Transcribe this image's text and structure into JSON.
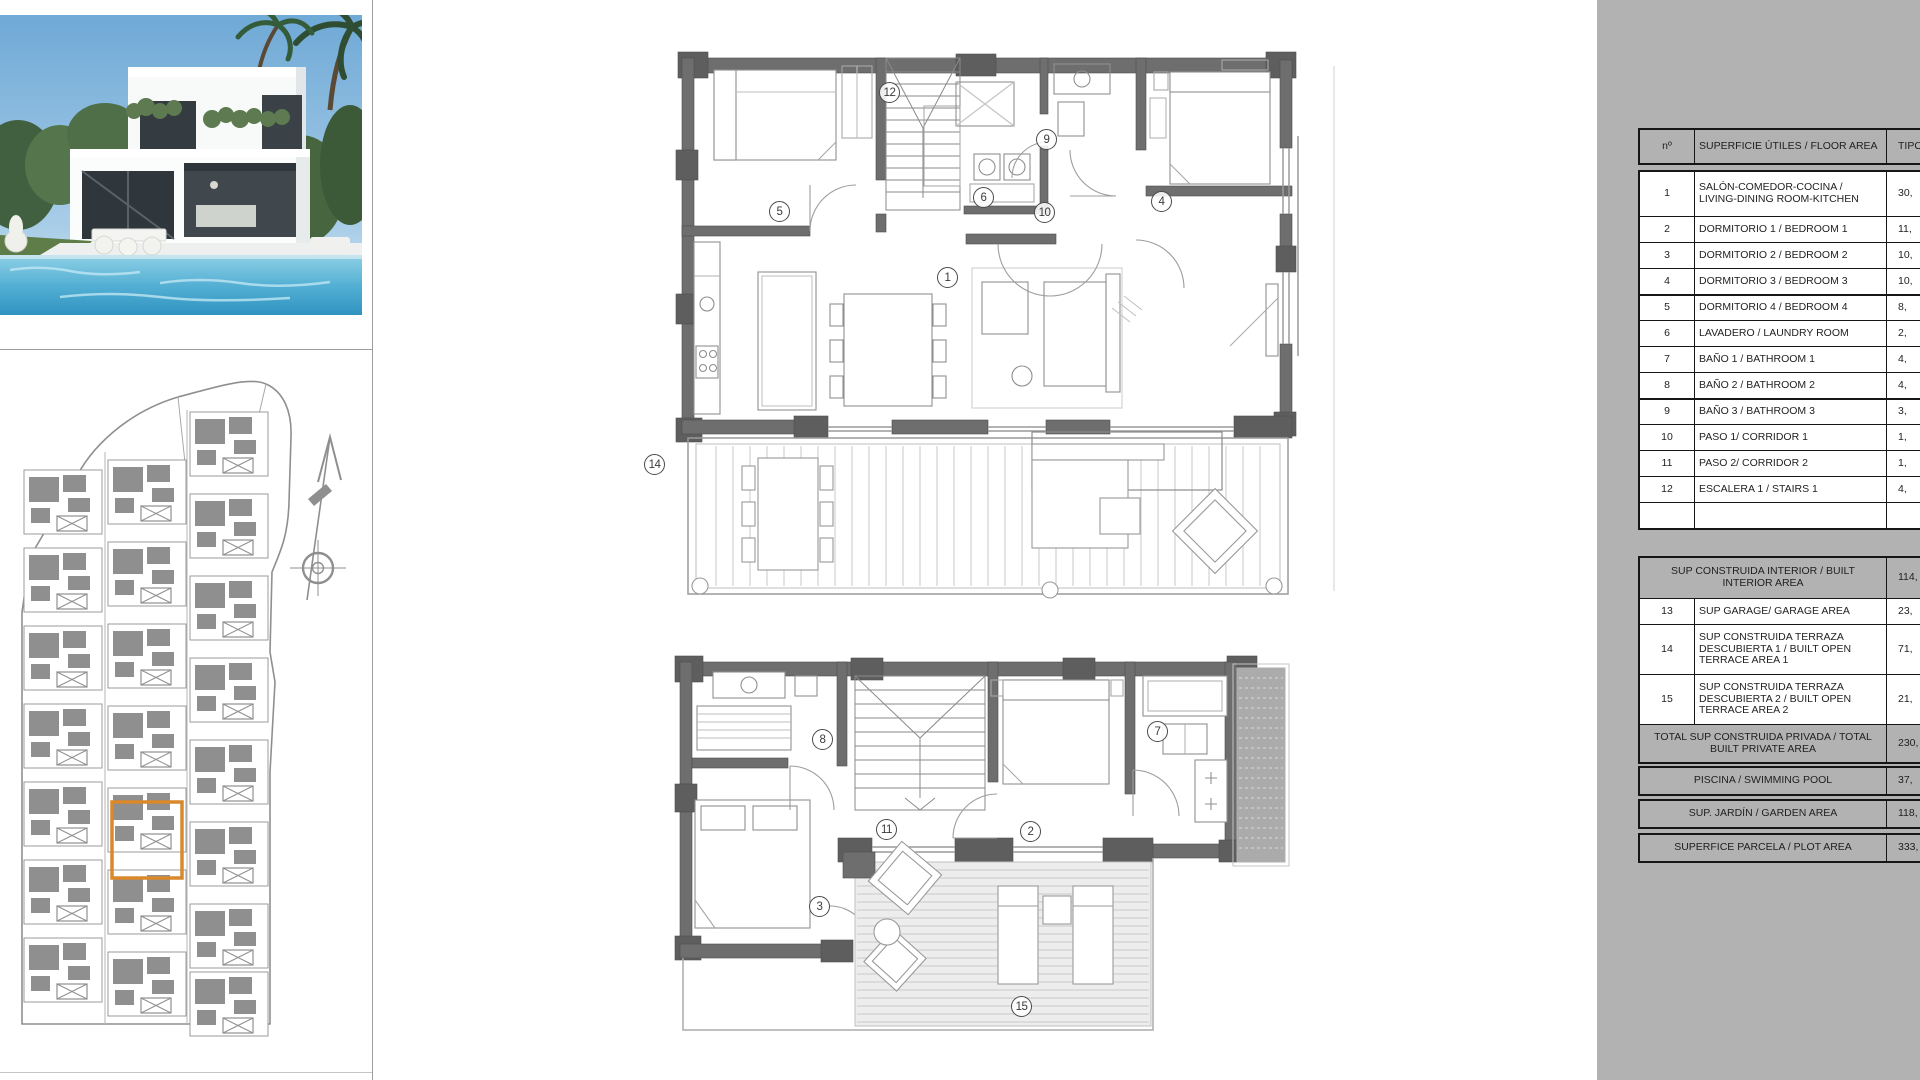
{
  "colors": {
    "accent_orange": "#D9882B",
    "panel_gray": "#B2B2B2",
    "wall_gray": "#6E6E6E",
    "drawing_gray": "#8F8F8F"
  },
  "table": {
    "header": {
      "num": "nº",
      "label": "SUPERFICIE ÚTILES / FLOOR AREA",
      "value": "TIPO"
    },
    "rows": [
      {
        "num": "1",
        "label": "SALÓN-COMEDOR-COCINA / LIVING-DINING ROOM-KITCHEN",
        "value": "30,"
      },
      {
        "num": "2",
        "label": "DORMITORIO 1 / BEDROOM 1",
        "value": "11,"
      },
      {
        "num": "3",
        "label": "DORMITORIO 2 / BEDROOM 2",
        "value": "10,"
      },
      {
        "num": "4",
        "label": "DORMITORIO 3 / BEDROOM 3",
        "value": "10,"
      },
      {
        "num": "5",
        "label": "DORMITORIO 4 / BEDROOM 4",
        "value": "8,"
      },
      {
        "num": "6",
        "label": "LAVADERO / LAUNDRY ROOM",
        "value": "2,"
      },
      {
        "num": "7",
        "label": "BAÑO 1 / BATHROOM 1",
        "value": "4,"
      },
      {
        "num": "8",
        "label": "BAÑO 2 / BATHROOM 2",
        "value": "4,"
      },
      {
        "num": "9",
        "label": "BAÑO 3 / BATHROOM 3",
        "value": "3,"
      },
      {
        "num": "10",
        "label": "PASO 1/ CORRIDOR 1",
        "value": "1,"
      },
      {
        "num": "11",
        "label": "PASO 2/ CORRIDOR 2",
        "value": "1,"
      },
      {
        "num": "12",
        "label": "ESCALERA 1 / STAIRS 1",
        "value": "4,"
      }
    ],
    "summary": {
      "interior": {
        "label": "SUP CONSTRUIDA INTERIOR / BUILT INTERIOR AREA",
        "value": "114,"
      },
      "garage": {
        "num": "13",
        "label": "SUP GARAGE/ GARAGE AREA",
        "value": "23,"
      },
      "terrace1": {
        "num": "14",
        "label": "SUP CONSTRUIDA TERRAZA DESCUBIERTA 1 / BUILT OPEN TERRACE AREA 1",
        "value": "71,"
      },
      "terrace2": {
        "num": "15",
        "label": "SUP CONSTRUIDA TERRAZA DESCUBIERTA 2 / BUILT OPEN TERRACE AREA 2",
        "value": "21,"
      },
      "total": {
        "label": "TOTAL SUP CONSTRUIDA PRIVADA / TOTAL BUILT PRIVATE AREA",
        "value": "230,"
      }
    },
    "pool": {
      "label": "PISCINA / SWIMMING POOL",
      "value": "37,"
    },
    "garden": {
      "label": "SUP. JARDÍN / GARDEN AREA",
      "value": "118,"
    },
    "plot": {
      "label": "SUPERFICE PARCELA / PLOT AREA",
      "value": "333,"
    }
  },
  "floor_plans": {
    "upper_markers": [
      {
        "n": "12",
        "x": 890,
        "y": 93
      },
      {
        "n": "9",
        "x": 1047,
        "y": 140
      },
      {
        "n": "5",
        "x": 780,
        "y": 212
      },
      {
        "n": "6",
        "x": 984,
        "y": 198
      },
      {
        "n": "10",
        "x": 1045,
        "y": 213
      },
      {
        "n": "4",
        "x": 1162,
        "y": 202
      },
      {
        "n": "1",
        "x": 948,
        "y": 278
      },
      {
        "n": "14",
        "x": 655,
        "y": 465
      }
    ],
    "lower_markers": [
      {
        "n": "8",
        "x": 823,
        "y": 740
      },
      {
        "n": "7",
        "x": 1158,
        "y": 732
      },
      {
        "n": "11",
        "x": 887,
        "y": 830
      },
      {
        "n": "2",
        "x": 1031,
        "y": 832
      },
      {
        "n": "3",
        "x": 820,
        "y": 907
      },
      {
        "n": "15",
        "x": 1022,
        "y": 1007
      }
    ]
  }
}
